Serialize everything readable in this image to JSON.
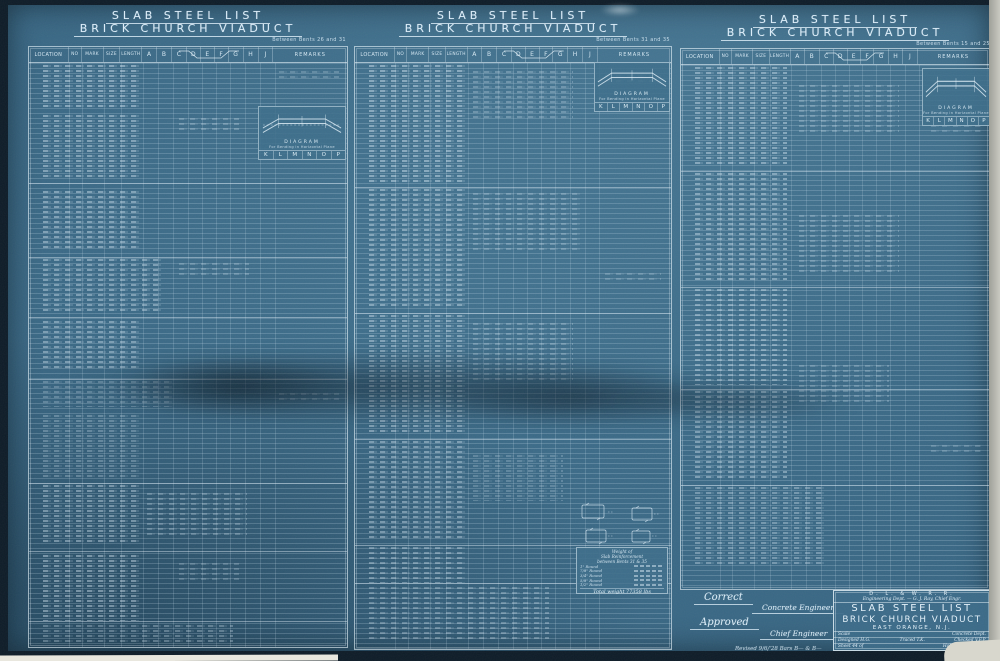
{
  "document": {
    "railroad": "D. L. & W. R. R.",
    "dept_line": "Engineering Dept. — G. J. Ray, Chief Engr.",
    "title": "SLAB STEEL LIST",
    "subtitle": "BRICK CHURCH VIADUCT",
    "location": "EAST ORANGE, N.J.",
    "scale_label": "Scale",
    "dept": "Concrete Dept.",
    "designed": "Designed H.G.",
    "traced": "Traced T.K.",
    "checked": "Checked V.F.P.",
    "sheet": "Sheet 44 of",
    "place_date": "Hoboken, N.J.  1923"
  },
  "panels": [
    {
      "title": "SLAB STEEL LIST",
      "subtitle": "BRICK CHURCH VIADUCT",
      "note": "Between Bents 26 and 31"
    },
    {
      "title": "SLAB STEEL LIST",
      "subtitle": "BRICK CHURCH VIADUCT",
      "note": "Between Bents 31 and 35"
    },
    {
      "title": "SLAB STEEL LIST",
      "subtitle": "BRICK CHURCH VIADUCT",
      "note": "Between Bents 15 and 25"
    }
  ],
  "table": {
    "headers": [
      "LOCATION",
      "NO",
      "MARK",
      "SIZE",
      "LENGTH",
      "A",
      "B",
      "C",
      "D",
      "E",
      "F",
      "G",
      "H",
      "J",
      "REMARKS"
    ]
  },
  "inset": {
    "label1": "DIAGRAM",
    "label2": "For Bending in Horizontal Plane",
    "letters": [
      "K",
      "L",
      "M",
      "N",
      "O",
      "P"
    ]
  },
  "weight_box": {
    "line1": "Weight of",
    "line2": "Slab Reinforcement",
    "line3": "between Bents 31 & 35",
    "items": [
      "1\" Round",
      "7/8\" Round",
      "3/4\" Round",
      "5/8\" Round",
      "1/2\" Round"
    ],
    "total": "Total weight 77358 lbs"
  },
  "signatures": {
    "correct": "Correct",
    "concrete_engineer": "Concrete Engineer",
    "approved": "Approved",
    "chief_engineer": "Chief Engineer",
    "revision_note": "Revised 9/6/'28  Bars B— & B—"
  },
  "colors": {
    "paper_blue": "#3a6a86",
    "ink_white": "#ddeefa",
    "grid_line": "rgba(214,233,246,0.20)",
    "scan_background": "#0e1c28",
    "scan_edge_gray": "#c9c9c1"
  }
}
